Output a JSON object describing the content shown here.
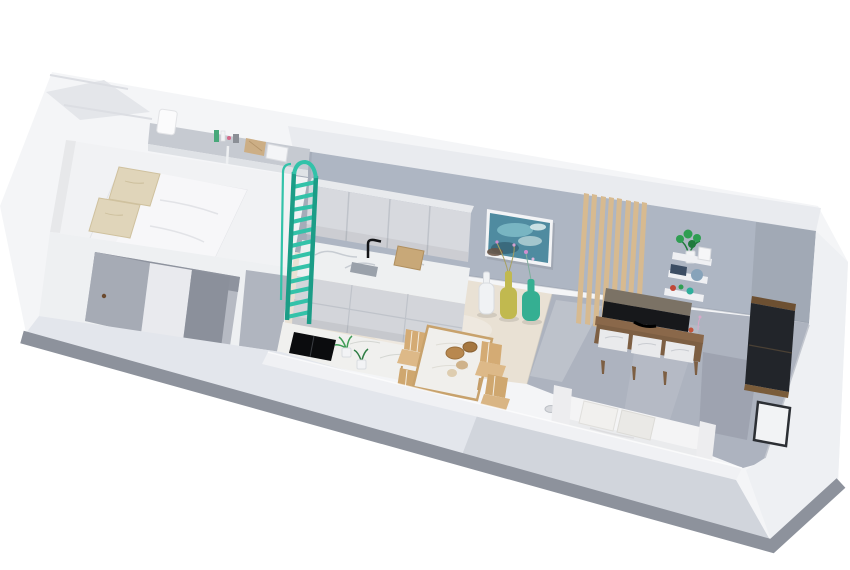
{
  "meta": {
    "kind": "3d-isometric-apartment-floorplan-render",
    "canvas": {
      "width": 850,
      "height": 570
    },
    "background": "#ffffff"
  },
  "palette": {
    "building_white": "#f4f5f7",
    "wall_top_band": "#e9ebef",
    "back_wall_grey": "#aeb6c3",
    "right_band_white": "#eef0f3",
    "floor_beige": "#e9e1d4",
    "floor_concrete": "#adb3bf",
    "front_outer": "#e3e6ec",
    "front_top_face": "#f0f1f4",
    "base_band": "#8d929c",
    "accent_teal": "#33c2a9",
    "accent_teal_dark": "#1b9d87",
    "cabinet_grey": "#d7d9de",
    "counter_marble": "#eef0f1",
    "wood_slat": "#d7ba90",
    "wood_brown": "#8a684a",
    "tv_dark": "#17181b",
    "tv_top": "#7b7265",
    "wardrobe_dark": "#22252a",
    "wardrobe_trim": "#6d5032",
    "painting_teal": "#4f8ba0",
    "vase_yellow": "#c1b94f",
    "vase_teal": "#35af92",
    "plant_green": "#2f9e52",
    "pillow_beige": "#e0d5ba",
    "chair_wood": "#d4ab74",
    "table_rim": "#c8a26c",
    "sofa_white": "#f4f4f5",
    "platform_white": "#f1f2f4",
    "alcove_grey": "#b6bac3",
    "niche_grey": "#c6cad1"
  },
  "scene": {
    "rooms": [
      {
        "id": "bedroom-loft",
        "items": [
          "double-bed",
          "beige-pillows",
          "headboard-niche-decor",
          "teal-loft-ladder"
        ]
      },
      {
        "id": "under-loft-alcove",
        "items": [
          "opening",
          "sliding-partition",
          "door-handle"
        ]
      },
      {
        "id": "kitchen",
        "items": [
          "upper-cabinets",
          "marble-counter-sink",
          "black-faucet",
          "cutting-board",
          "base-cabinets",
          "cooktop-counter",
          "induction-hob",
          "herb-plants"
        ]
      },
      {
        "id": "dining-area",
        "items": [
          "marble-dining-table",
          "wooden-chairs",
          "decorative-bowls"
        ]
      },
      {
        "id": "living-area",
        "items": [
          "ocean-wall-art",
          "floor-vases-white-yellow-teal",
          "wood-slat-accent-panel",
          "tv",
          "media-console-marble-drawers",
          "wall-shelf-with-monstera",
          "dark-wardrobe",
          "white-sofa"
        ]
      }
    ]
  }
}
